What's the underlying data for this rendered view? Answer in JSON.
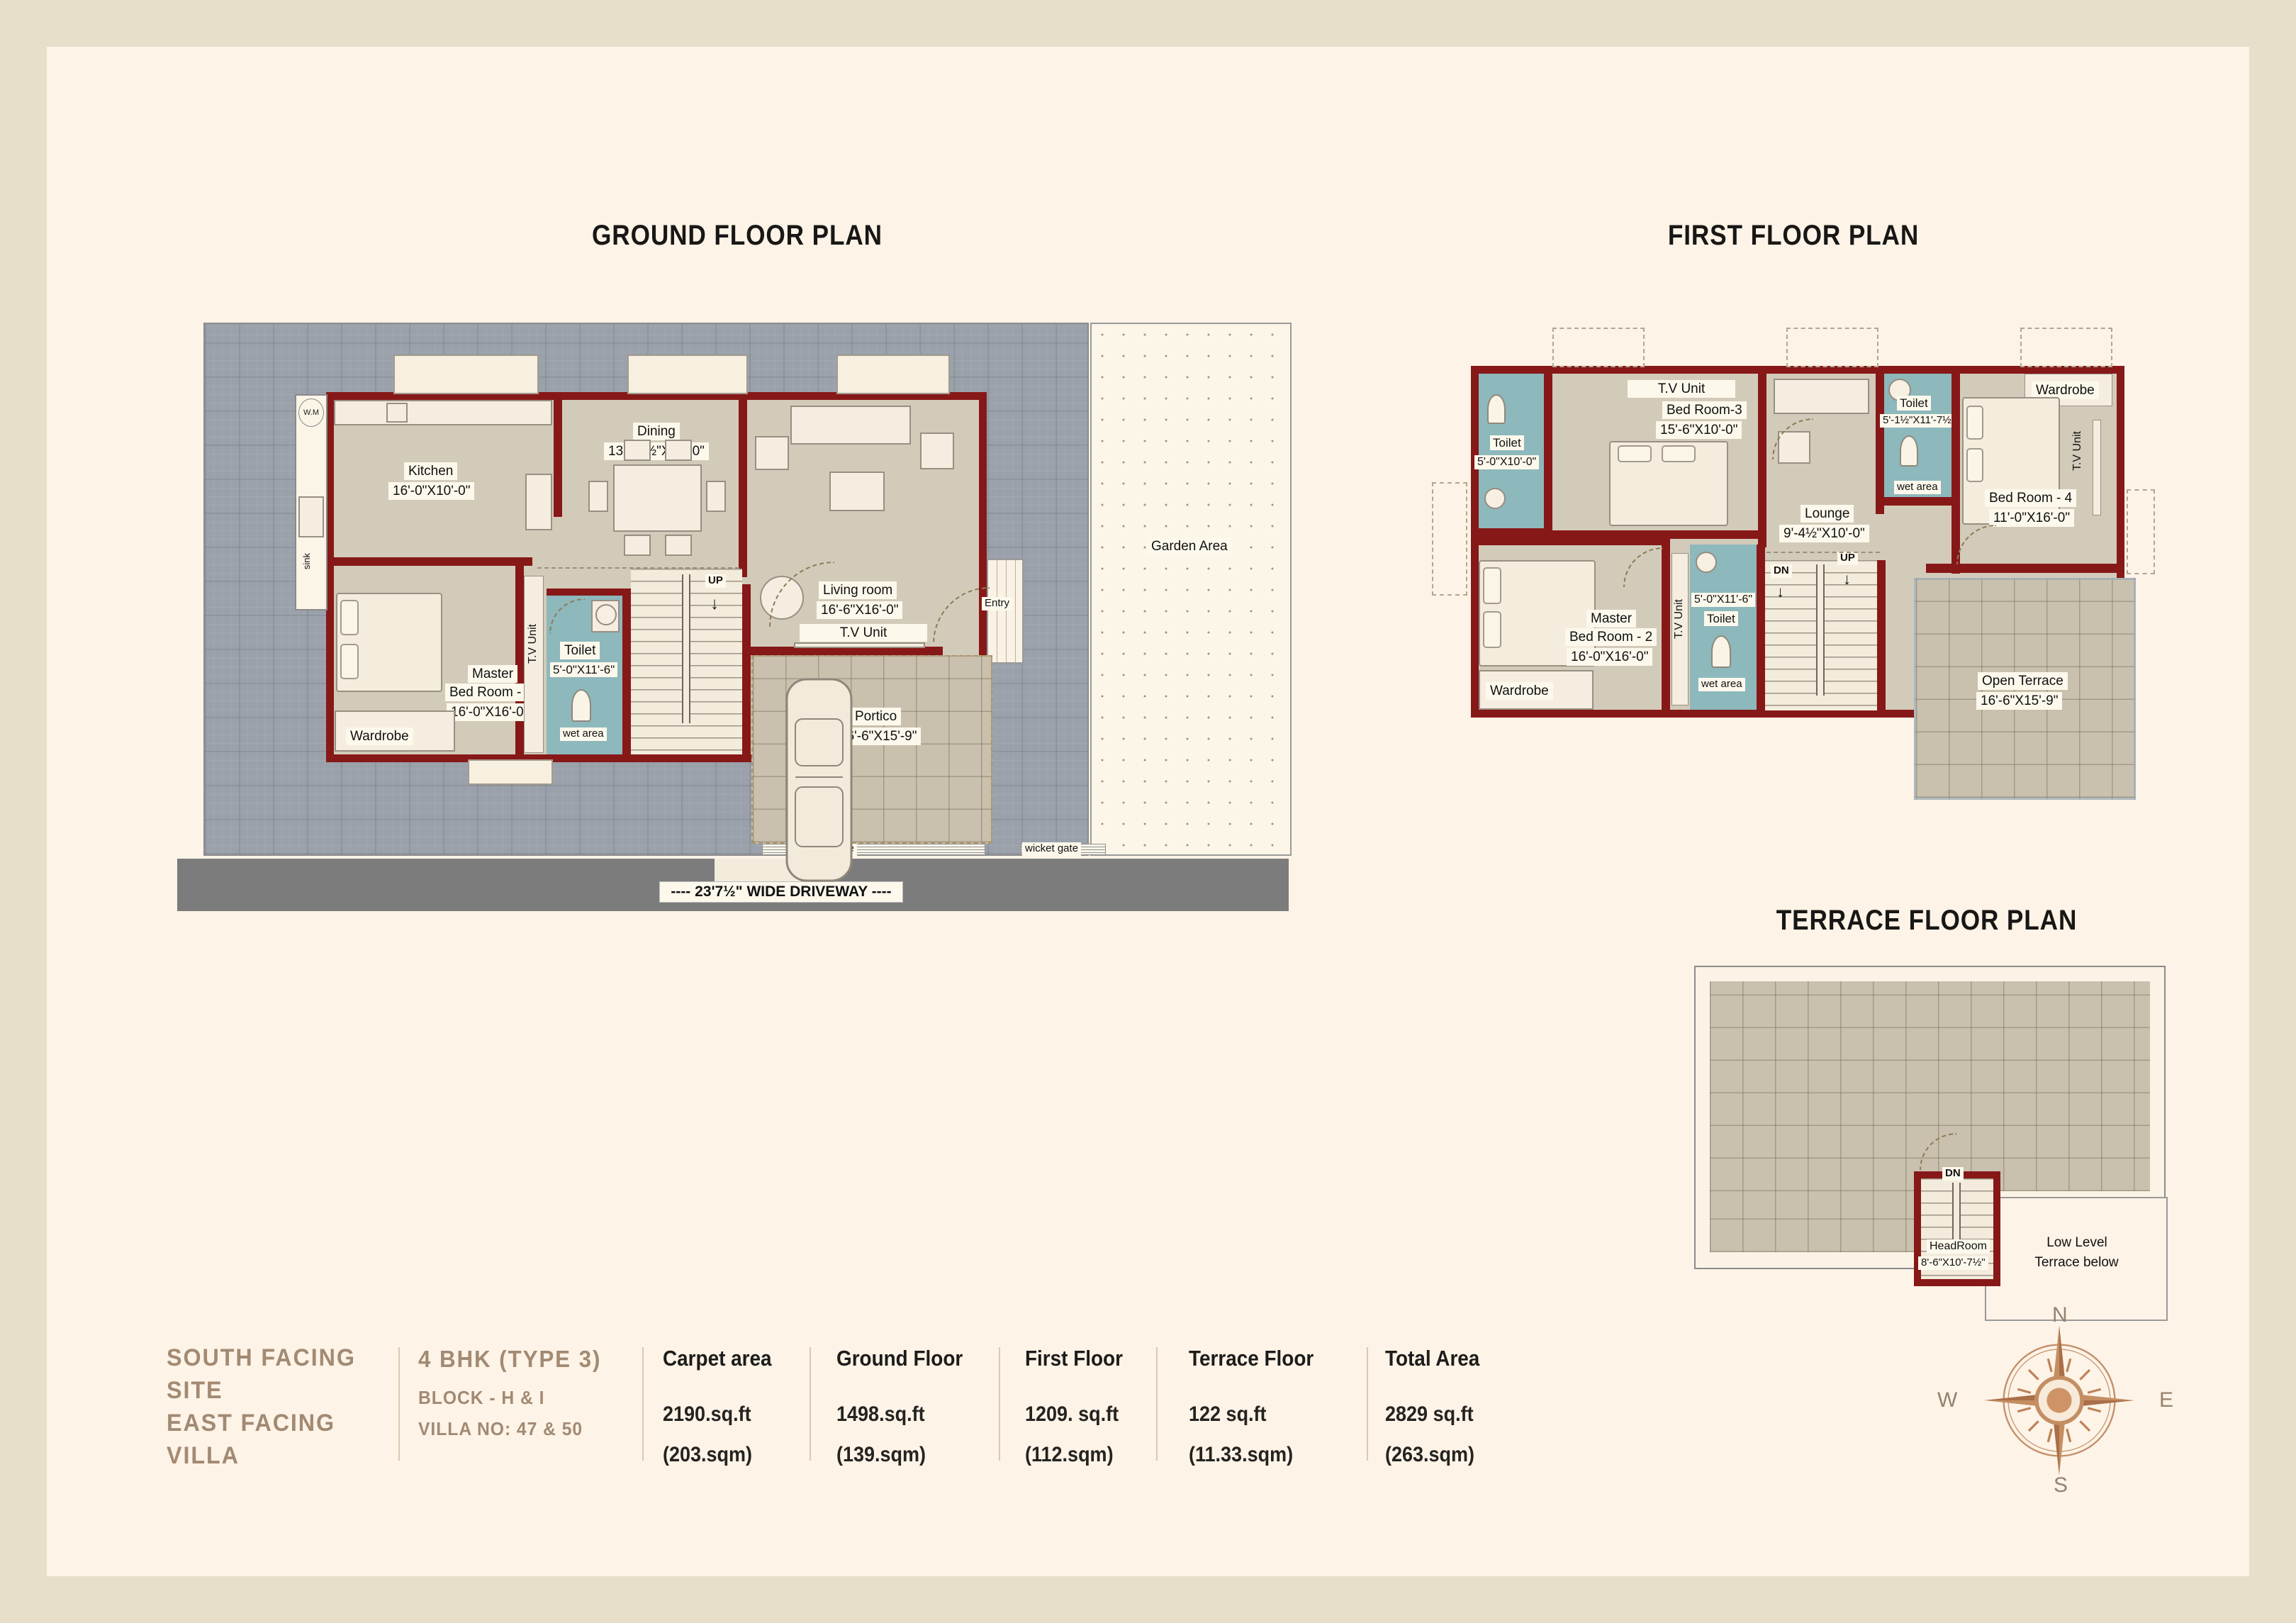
{
  "titles": {
    "gf": "GROUND FLOOR PLAN",
    "ff": "FIRST FLOOR PLAN",
    "tf": "TERRACE FLOOR PLAN"
  },
  "gf": {
    "kitchen_name": "Kitchen",
    "kitchen_dim": "16'-0\"X10'-0\"",
    "dining_name": "Dining",
    "dining_dim": "13'-10½\"X10'-0\"",
    "living_name": "Living room",
    "living_dim": "16'-6\"X16'-0\"",
    "master_l1": "Master",
    "master_l2": "Bed Room - 1",
    "master_dim": "16'-0\"X16'-0\"",
    "toilet_name": "Toilet",
    "toilet_dim": "5'-0\"X11'-6\"",
    "wet": "wet area",
    "wardrobe": "Wardrobe",
    "tv_v": "T.V Unit",
    "tv_h": "T.V Unit",
    "up": "UP",
    "wm": "W.M",
    "sink": "sink",
    "entry": "Entry",
    "portico_name": "Portico",
    "portico_dim": "16'-6\"X15'-9\"",
    "garden": "Garden Area",
    "main_gate": "Main gate",
    "wicket_gate": "wicket gate",
    "driveway": "----  23'7½\" WIDE DRIVEWAY  ----"
  },
  "ff": {
    "toilet1_name": "Toilet",
    "toilet1_dim": "5'-0\"X10'-0\"",
    "tv_top": "T.V Unit",
    "br3_name": "Bed Room-3",
    "br3_dim": "15'-6\"X10'-0\"",
    "lounge_name": "Lounge",
    "lounge_dim": "9'-4½\"X10'-0\"",
    "toilet2_name": "Toilet",
    "toilet2_dim": "5'-1½\"X11'-7½\"",
    "wet2": "wet area",
    "wardrobe_tr": "Wardrobe",
    "tv_right": "T.V Unit",
    "br4_name": "Bed Room - 4",
    "br4_dim": "11'-0\"X16'-0\"",
    "master_l1": "Master",
    "master_l2": "Bed Room - 2",
    "master_dim": "16'-0\"X16'-0\"",
    "tv_mid": "T.V Unit",
    "toilet3_dim": "5'-0\"X11'-6\"",
    "toilet3_name": "Toilet",
    "wet3": "wet area",
    "wardrobe_bl": "Wardrobe",
    "up": "UP",
    "dn": "DN",
    "terrace_name": "Open Terrace",
    "terrace_dim": "16'-6\"X15'-9\""
  },
  "tf": {
    "dn": "DN",
    "headroom_name": "HeadRoom",
    "headroom_dim": "8'-6\"X10'-7½\"",
    "low1": "Low Level",
    "low2": "Terrace below"
  },
  "info": {
    "site_l1": "SOUTH FACING",
    "site_l2": "SITE",
    "site_l3": "EAST FACING",
    "site_l4": "VILLA",
    "type": "4 BHK (TYPE 3)",
    "block": "BLOCK - H & I",
    "villa_no": "VILLA NO: 47 & 50",
    "cols": [
      {
        "h": "Carpet area",
        "v": "2190.sq.ft",
        "s": "(203.sqm)"
      },
      {
        "h": "Ground Floor",
        "v": "1498.sq.ft",
        "s": "(139.sqm)"
      },
      {
        "h": "First Floor",
        "v": "1209. sq.ft",
        "s": "(112.sqm)"
      },
      {
        "h": "Terrace Floor",
        "v": "122 sq.ft",
        "s": "(11.33.sqm)"
      },
      {
        "h": "Total Area",
        "v": "2829 sq.ft",
        "s": "(263.sqm)"
      }
    ]
  },
  "compass": {
    "n": "N",
    "e": "E",
    "s": "S",
    "w": "W"
  },
  "colors": {
    "wall": "#871818",
    "toilet": "#8db8bc",
    "accent_text": "#a28a73",
    "paving": "#9aa1ab"
  }
}
